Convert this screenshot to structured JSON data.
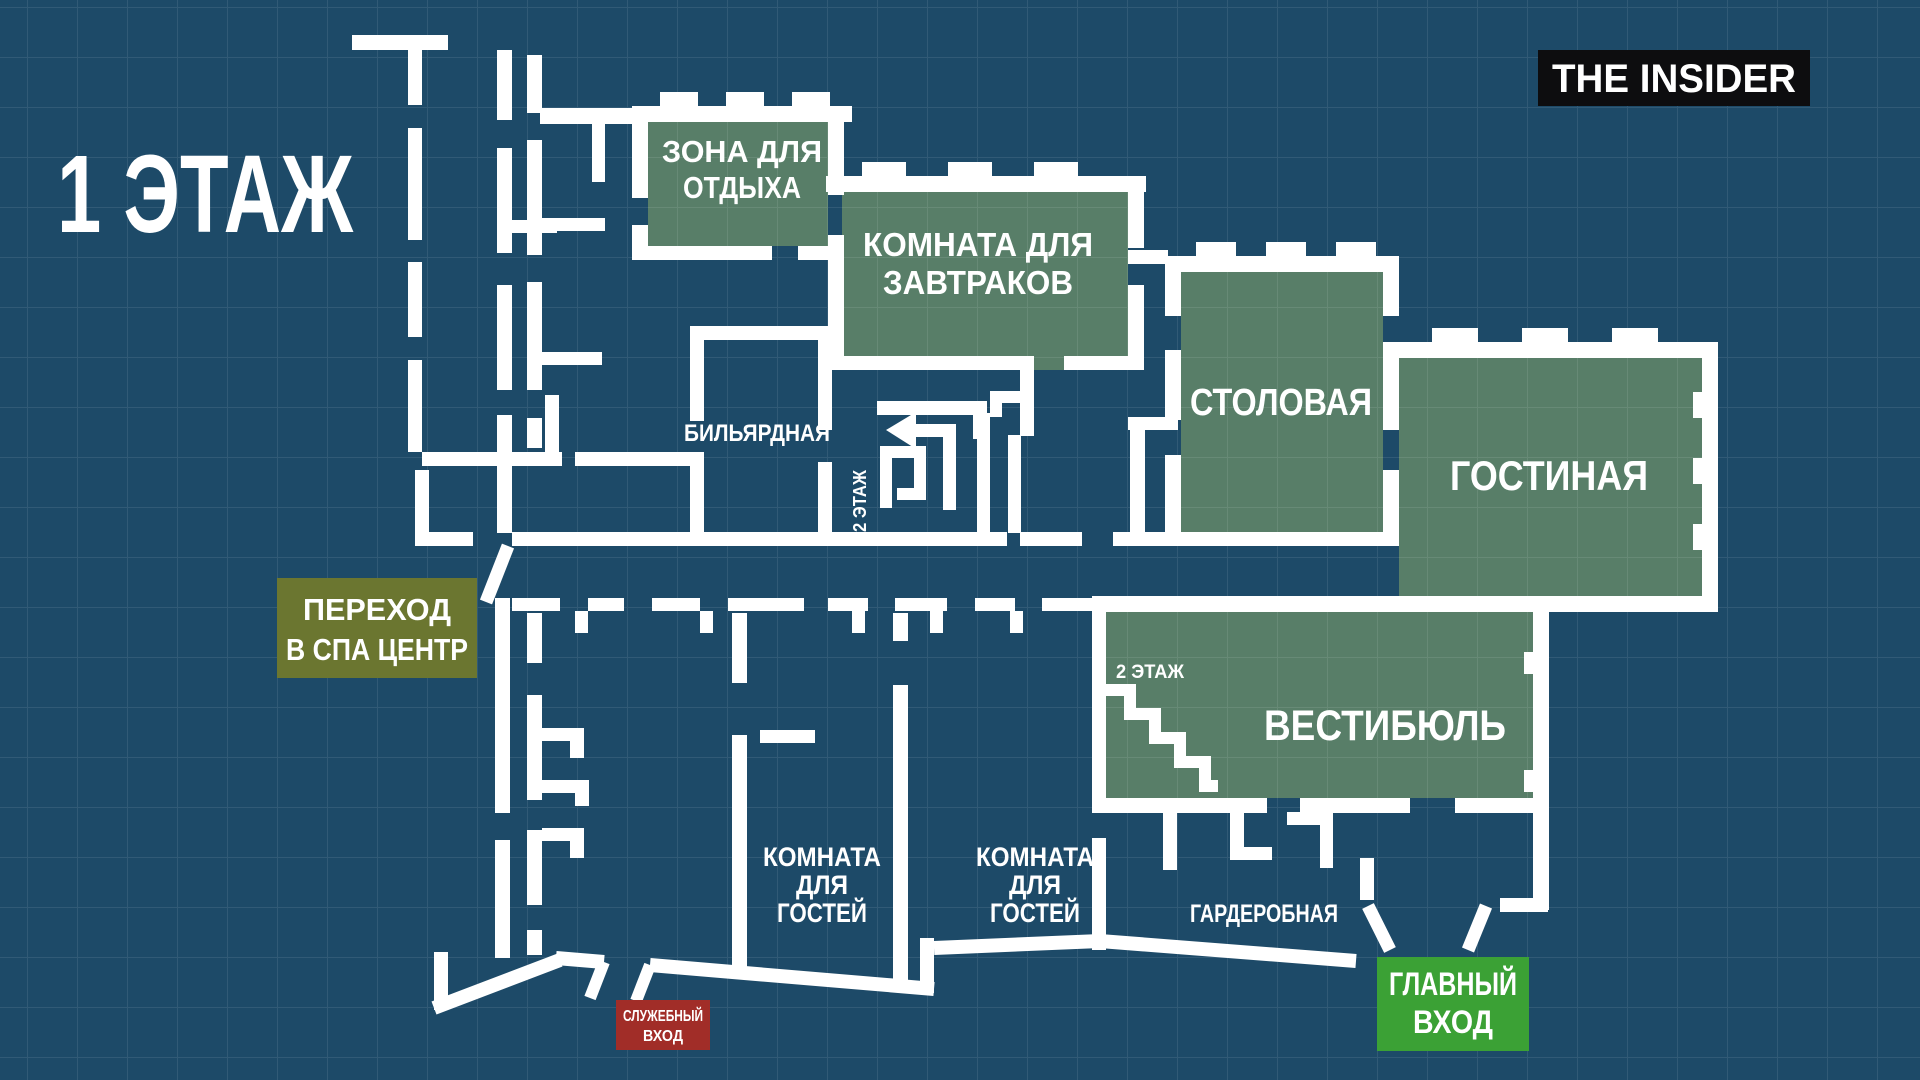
{
  "page": {
    "bg": "#1d4a68",
    "grid_color": "rgba(255,255,255,0.09)",
    "wall_color": "#ffffff",
    "room_green": "#587e68"
  },
  "title": "1 ЭТАЖ",
  "logo": {
    "text": "THE INSIDER",
    "bg": "#0d0d0f",
    "fg": "#ffffff"
  },
  "rooms": {
    "rest": {
      "line1": "ЗОНА ДЛЯ",
      "line2": "ОТДЫХА"
    },
    "breakfast": {
      "line1": "КОМНАТА ДЛЯ",
      "line2": "ЗАВТРАКОВ"
    },
    "dining": {
      "label": "СТОЛОВАЯ"
    },
    "living": {
      "label": "ГОСТИНАЯ"
    },
    "billiard": {
      "label": "БИЛЬЯРДНАЯ"
    },
    "vestibule": {
      "label": "ВЕСТИБЮЛЬ"
    },
    "cloakroom": {
      "label": "ГАРДЕРОБНАЯ"
    },
    "guest_left": {
      "line1": "КОМНАТА",
      "line2": "ДЛЯ",
      "line3": "ГОСТЕЙ"
    },
    "guest_right": {
      "line1": "КОМНАТА",
      "line2": "ДЛЯ",
      "line3": "ГОСТЕЙ"
    }
  },
  "stairs": {
    "upper_label": "2 ЭТАЖ",
    "vestibule_label": "2 ЭТАЖ"
  },
  "badges": {
    "spa": {
      "line1": "ПЕРЕХОД",
      "line2": "В СПА ЦЕНТР",
      "bg": "#6b7630"
    },
    "main_entrance": {
      "line1": "ГЛАВНЫЙ",
      "line2": "ВХОД",
      "bg": "#3ba135"
    },
    "service_entrance": {
      "line1": "СЛУЖЕБНЫЙ",
      "line2": "ВХОД",
      "bg": "#a12d28"
    }
  }
}
